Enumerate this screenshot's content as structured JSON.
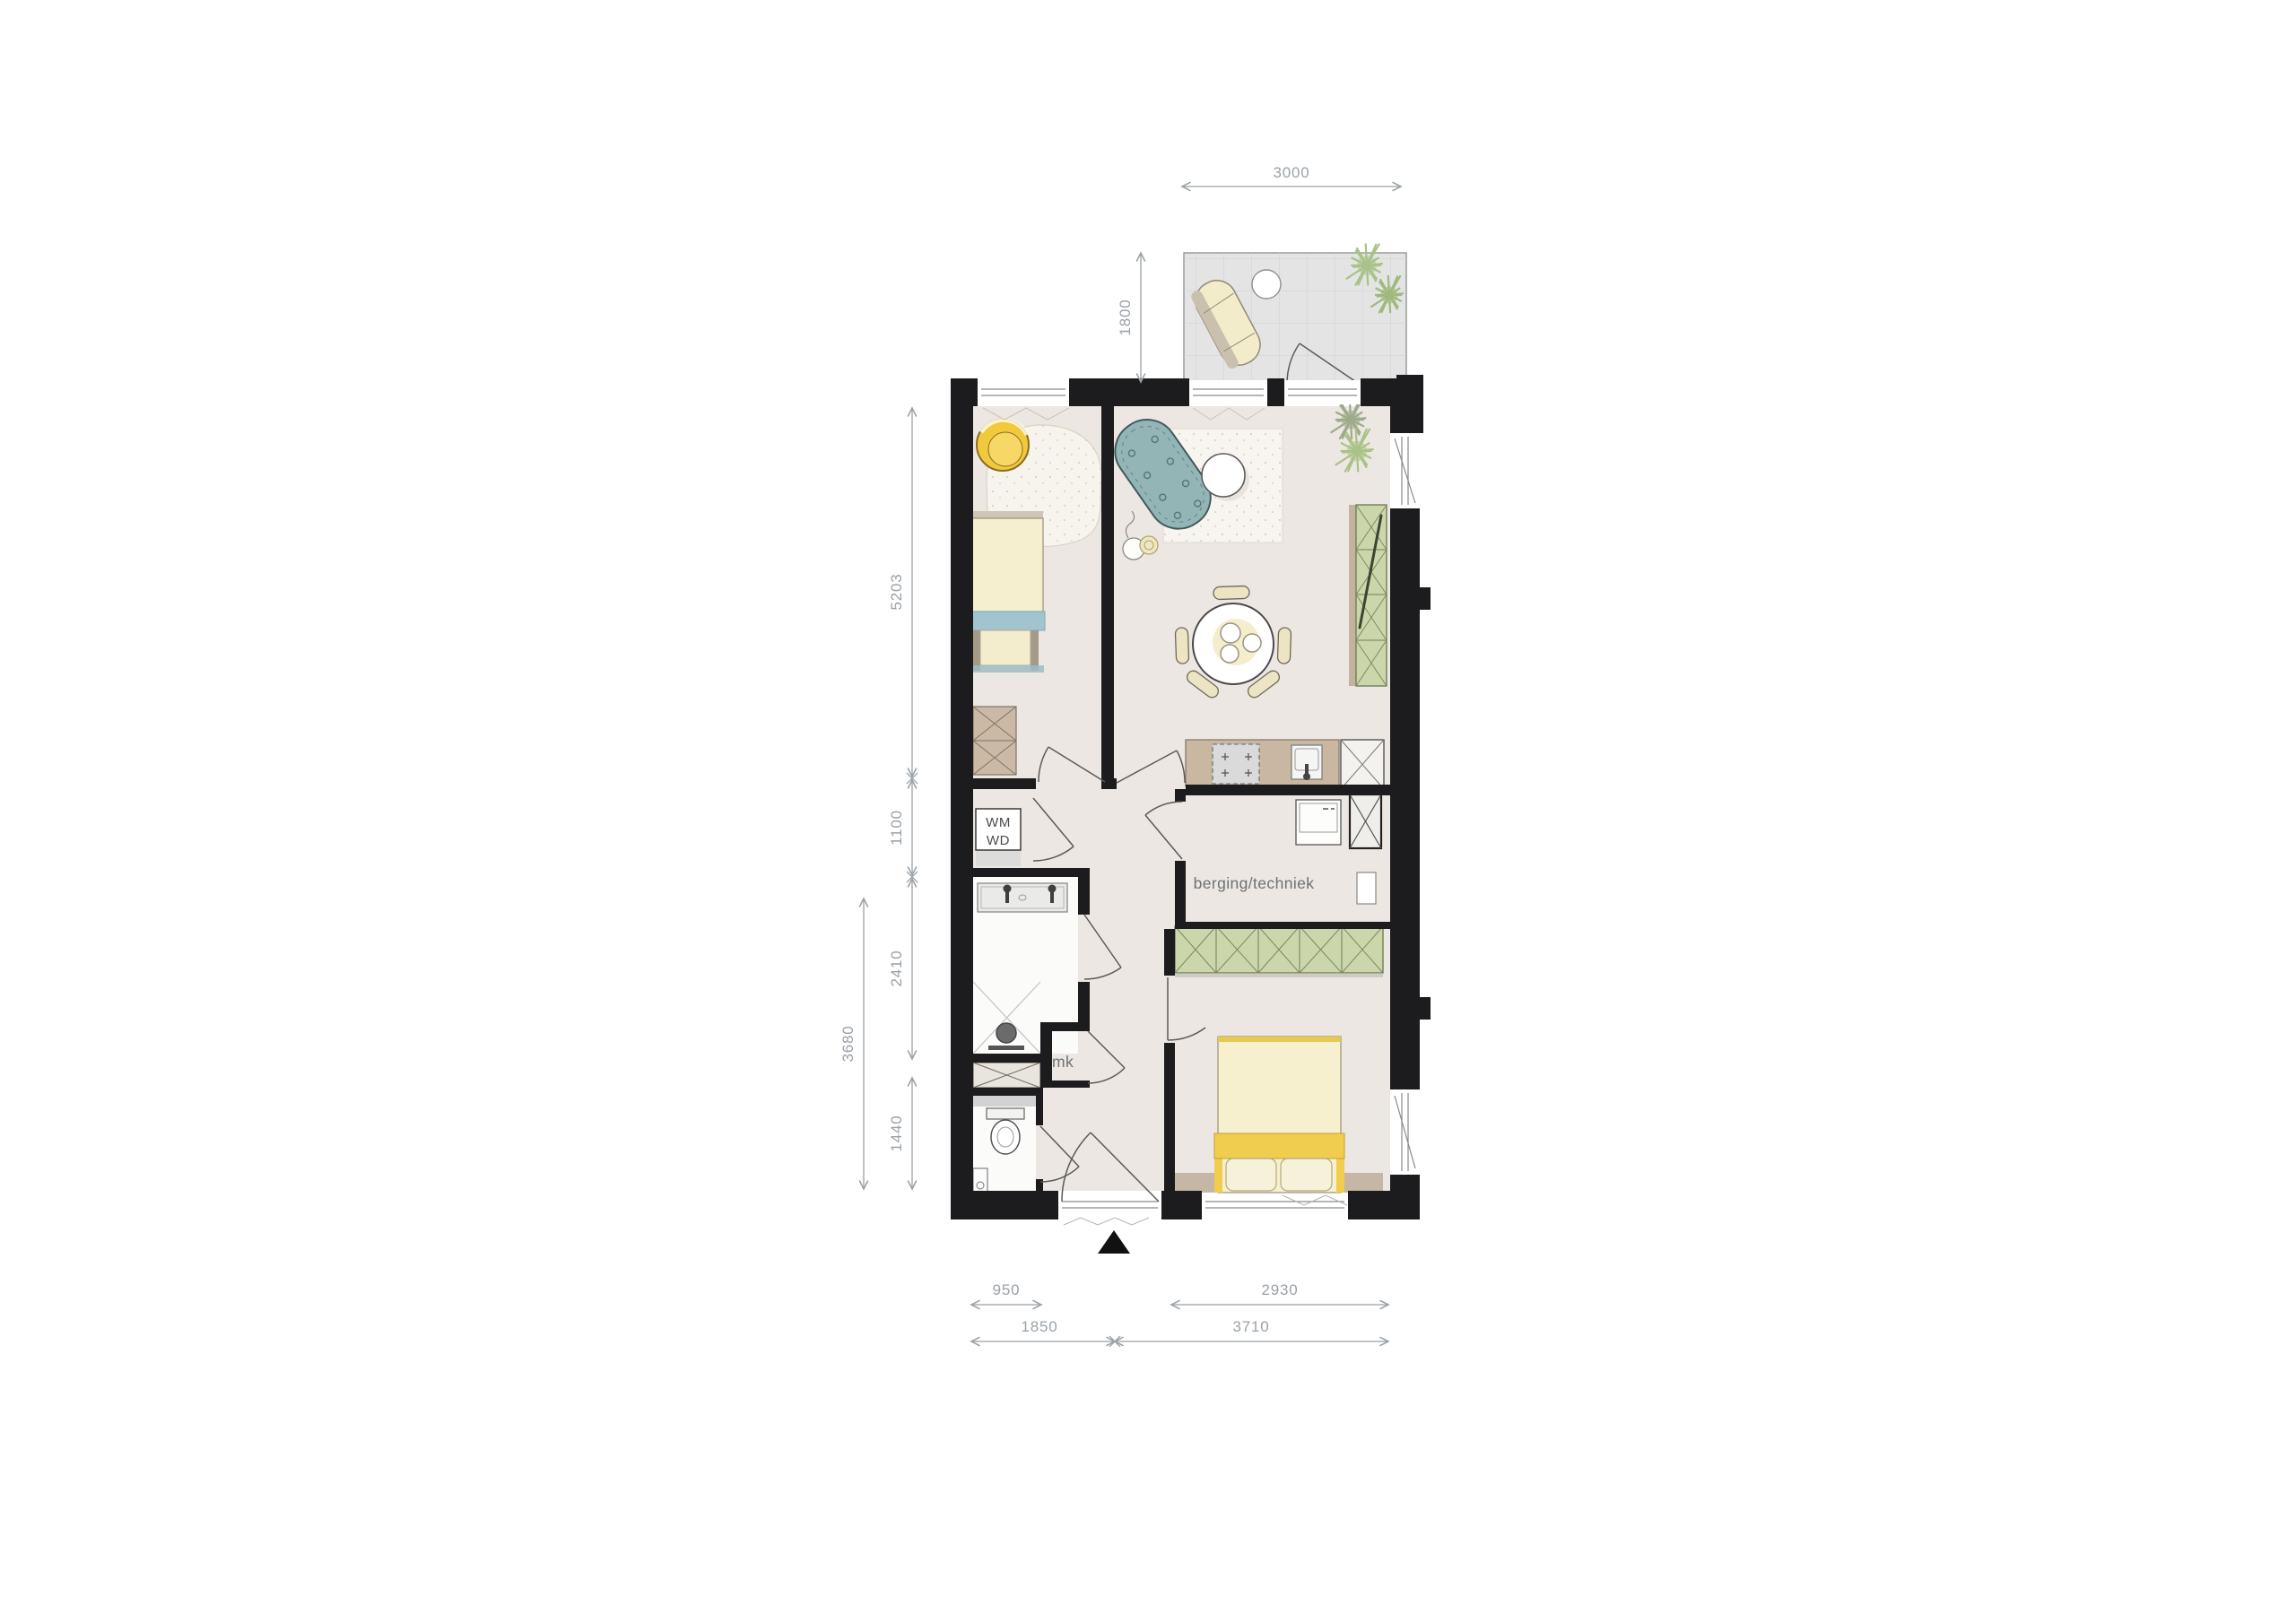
{
  "labels": {
    "storage_room": "berging/techniek",
    "washing_machine": "WM",
    "washer_dryer": "WD",
    "meter_cupboard": "mk"
  },
  "dimensions": {
    "balcony_width": "3000",
    "balcony_depth": "1800",
    "left_upper": "5203",
    "left_hall": "1100",
    "left_bathroom": "2410",
    "left_lower_total": "3680",
    "left_toilet": "1440",
    "bottom_toilet_width": "950",
    "bottom_entry_total": "1850",
    "bottom_bedroom": "2930",
    "bottom_bedroom_total": "3710"
  },
  "colors": {
    "wall": "#1c1c1e",
    "floor": "#ece7e2",
    "wet_floor": "#fbfbfa",
    "balcony_floor": "#e4e4e4",
    "dimension": "#9aa1a7",
    "sofa": "#93b5b6",
    "armchair": "#f2c83d",
    "bed_linen": "#f5efcf",
    "blanket": "#f0cc4f",
    "bed_accent": "#a2c4cf",
    "cabinet_green": "#ccd6ab",
    "counter_tan": "#c9b7a2",
    "plant_green": "#a9c287"
  }
}
